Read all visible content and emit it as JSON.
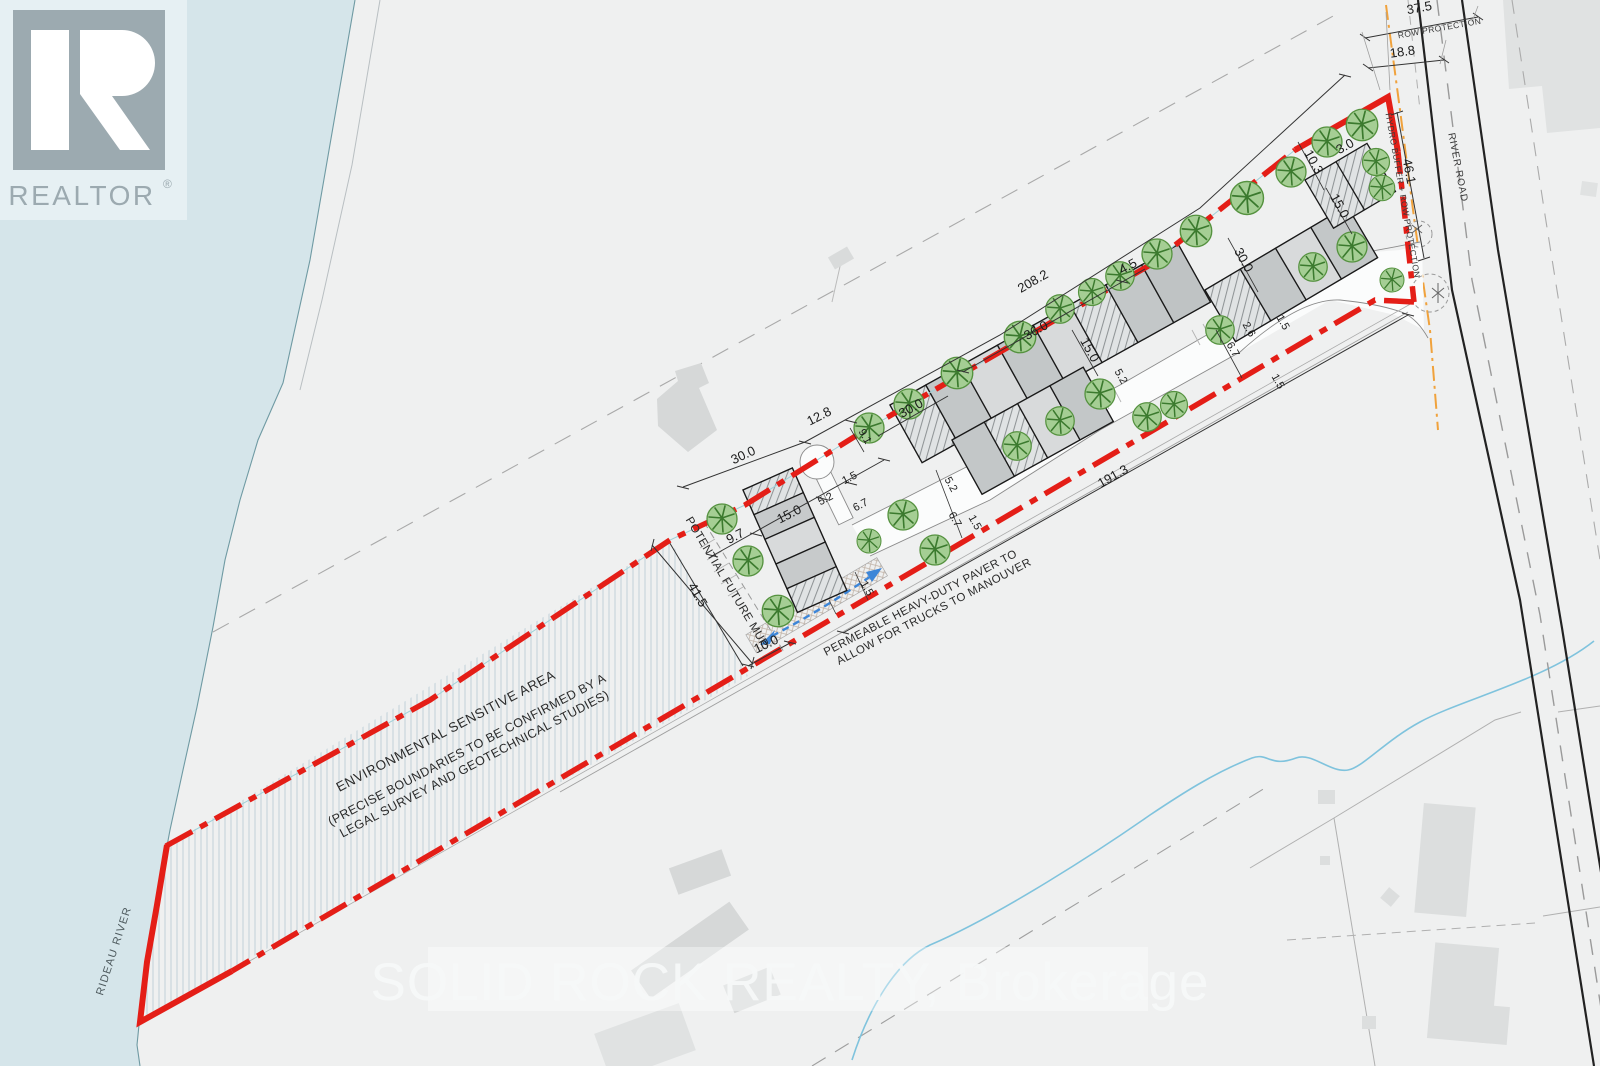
{
  "branding": {
    "logo": "REALTOR",
    "registered": "®"
  },
  "watermark": "SOLID ROCK REALTY, Brokerage",
  "labels": {
    "river": "RIDEAU RIVER",
    "road": "RIVER ROAD",
    "row_protection": "ROW PROTECTION",
    "hydro_buffer": "HYDRO BUFFER + ROW PROTECTION",
    "future_mup": "POTENTIAL FUTURE MUP",
    "esa1": "ENVIRONMENTAL SENSITIVE AREA",
    "esa2": "(PRECISE BOUNDARIES TO BE CONFIRMED BY A",
    "esa3": "LEGAL SURVEY AND GEOTECHNICAL STUDIES)",
    "paver1": "PERMEABLE HEAVY-DUTY PAVER TO",
    "paver2": "ALLOW FOR TRUCKS TO MANOUVER"
  },
  "dims": {
    "total_frontage": "208.2",
    "south_length": "191.3",
    "esa_width": "41.5",
    "mup_width": "10.0",
    "row_width": "37.5",
    "row_inner": "18.8",
    "road_frontage": "46.1",
    "w30a": "30.0",
    "w12_8": "12.8",
    "w36": "36.0",
    "w4_5": "4.5",
    "w30b": "30.0",
    "w9_1": "9.1",
    "w15a": "15.0",
    "w5_2a": "5.2",
    "w6_7a": "6.7",
    "w1_5a": "1.5",
    "w9_7": "9.7",
    "w15b": "15.0",
    "w5_2b": "5.2",
    "w1_5b": "1.5",
    "w6_7b": "6.7",
    "w5_2c": "5.2",
    "w1_5paver": "1.5",
    "w30c": "30.0",
    "w15c": "15.0",
    "w10_3": "10.3",
    "w3_0": "3.0",
    "w2_6": "2.6",
    "w6_7c": "6.7",
    "w1_5c": "1.5",
    "w1_5d": "1.5"
  },
  "colors": {
    "boundary_red": "#e41e17",
    "hydro_orange": "#f0a23c",
    "water_blue": "#d5e5ea",
    "tree_green": "#a5ce94",
    "arrow_blue": "#3d86d8",
    "logo_gray": "#9caab0"
  }
}
